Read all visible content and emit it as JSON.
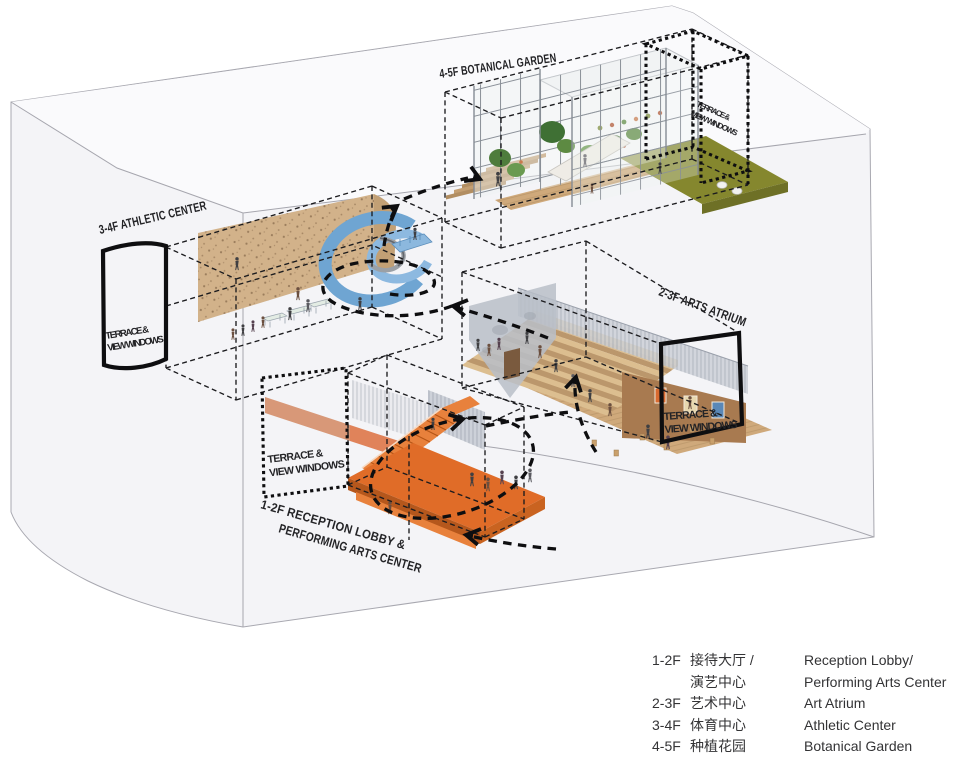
{
  "diagram": {
    "type": "exploded axonometric building program diagram",
    "volume_labels": {
      "botanical": "4-5F BOTANICAL GARDEN",
      "athletic": "3-4F ATHLETIC CENTER",
      "arts": "2-3F ARTS ATRIUM",
      "reception_line1": "1-2F RECEPTION LOBBY &",
      "reception_line2": "PERFORMING ARTS CENTER"
    },
    "terrace_tag": {
      "line1": "TERRACE &",
      "line2": "VIEW WINDOWS"
    }
  },
  "legend": {
    "lines": [
      {
        "floor": "1-2F",
        "zh": "接待大厅 /",
        "en": "Reception Lobby/"
      },
      {
        "floor": "",
        "zh": "演艺中心",
        "en": "Performing Arts Center"
      },
      {
        "floor": "2-3F",
        "zh": "艺术中心",
        "en": "Art Atrium"
      },
      {
        "floor": "3-4F",
        "zh": "体育中心",
        "en": "Athletic Center"
      },
      {
        "floor": "4-5F",
        "zh": "种植花园",
        "en": "Botanical Garden"
      }
    ]
  },
  "colors": {
    "ink": "#0e0e10",
    "envelope_line": "#a6a6ae",
    "lobby_orange": "#e06c28",
    "lobby_orange_dark": "#b5571c",
    "stair_orange": "#e8813c",
    "track_blue": "#6fa5d2",
    "track_blue_light": "#8db9e0",
    "climbing_wall": "#d2b28a",
    "wood": "#cfa97b",
    "wood_step_light": "#dcbe90",
    "wood_step_dark": "#bb976c",
    "lawn_green": "#85872e",
    "plant_green": "#4e7c3c",
    "curtain_gray": "#c9cdd5",
    "gallery_brown": "#a87a50"
  }
}
